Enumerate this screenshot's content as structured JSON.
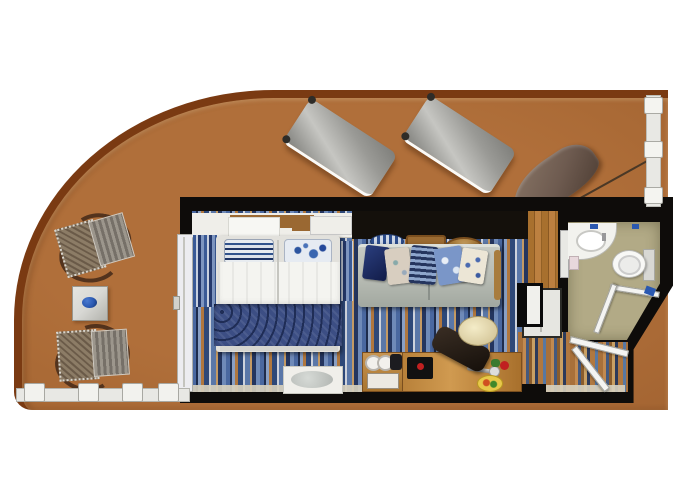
{
  "scene": {
    "type": "floor-plan",
    "subject": "cruise-ship balcony stateroom, top-down plan view",
    "text_content": "none — the image contains no rendered text"
  },
  "palette": {
    "deck": "#b06f3a",
    "rail": "#7a3a12",
    "wall": "#0e0c0a",
    "bath-floor": "#b2aa86",
    "wood-floor": "#a8702e",
    "desk-wood": "#d09a50",
    "sofa": "#b6bab2",
    "lounger": "#9a9a96",
    "clamshell": "#6e5b50",
    "fixture-white": "#f2f2ee",
    "duvet": "#f4f4f0",
    "blanket": "#3c4e84",
    "curtain-blue": "#3a5a96",
    "accent-blue": "#2a58b0",
    "accent-red": "#c02020",
    "accent-yellow": "#e8c84a",
    "deck-table": "#d8d8d4",
    "railing-white": "#e8e8e4"
  },
  "areas": [
    {
      "id": "balcony",
      "description": "large curved teak-railed balcony deck"
    },
    {
      "id": "bedroom",
      "description": "bed with white duvet, blue paisley blanket, two pillows"
    },
    {
      "id": "living-area",
      "description": "sofa with five pillows, desk, chair, minibar"
    },
    {
      "id": "bathroom",
      "description": "vanity sink, toilet, grab bar, angled corner"
    },
    {
      "id": "entry",
      "description": "entry corridor with two open doors"
    }
  ],
  "furniture": [
    "sun-lounger x2",
    "clamshell-shade",
    "deck-chair x2",
    "deck-side-table with blue plate",
    "double-bed",
    "headboard-shelf",
    "curtains",
    "sofa",
    "wall-shelf with dish, tray, basket",
    "tv-panel",
    "closet",
    "bench with glass top",
    "minibar with cups and kettle",
    "desk with phone, hairdryer, flower, fruit plate",
    "desk-chair with round cream cushion",
    "vanity-sink",
    "toilet",
    "balcony-partition",
    "deck-railing"
  ]
}
